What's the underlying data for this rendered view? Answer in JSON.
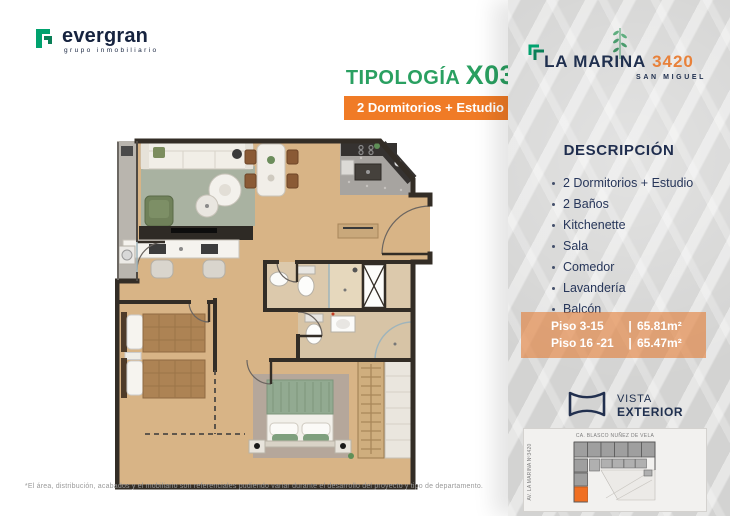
{
  "brand": {
    "name": "evergran",
    "tagline": "grupo inmobiliario"
  },
  "typology": {
    "label": "TIPOLOGÍA ",
    "code": "X03",
    "badge": "2 Dormitorios + Estudio"
  },
  "project": {
    "name": "LA MARINA",
    "number": "3420",
    "district": "SAN MIGUEL"
  },
  "description": {
    "heading": "DESCRIPCIÓN",
    "items": [
      "2 Dormitorios + Estudio",
      "2 Baños",
      "Kitchenette",
      "Sala",
      "Comedor",
      "Lavandería",
      "Balcón"
    ]
  },
  "floor_info": {
    "divider": "|",
    "rows": [
      {
        "label": "Piso 3-15",
        "area": "65.81m²"
      },
      {
        "label": "Piso 16 -21",
        "area": "65.47m²"
      }
    ]
  },
  "vista": {
    "line1": "VISTA",
    "line2": "EXTERIOR"
  },
  "map": {
    "street_top": "CA. BLASCO NUÑEZ DE VELA",
    "street_left": "AV. LA MARINA Nº3420"
  },
  "disclaimer": "*El área, distribución, acabados y el mobiliario son referenciales pudiendo variar durante el desarrollo del proyecto y tipo de departamento.",
  "colors": {
    "green": "#2aa061",
    "orange": "#f07b26",
    "navy": "#20304f"
  }
}
